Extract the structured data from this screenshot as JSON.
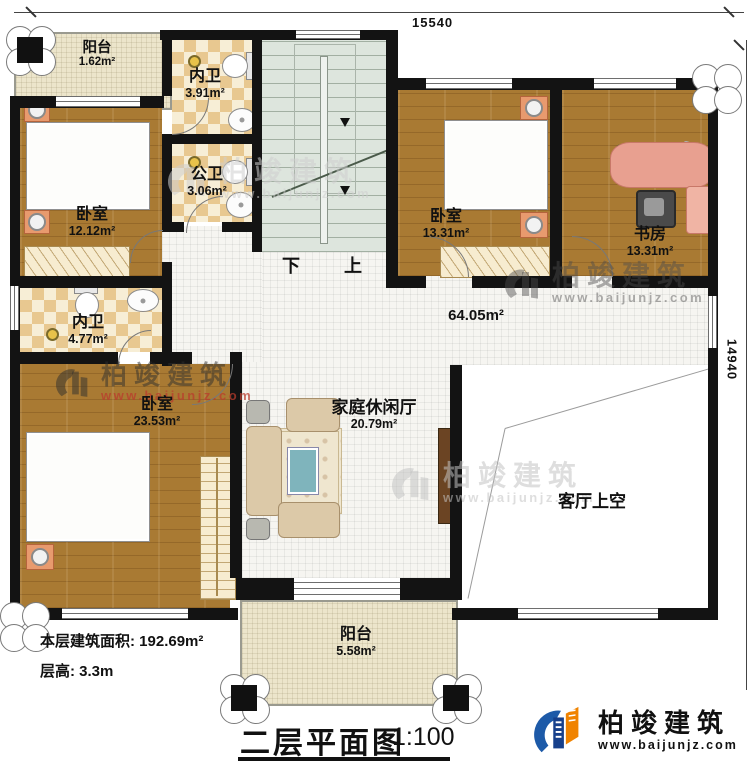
{
  "dimensions": {
    "top": "15540",
    "right": "14940"
  },
  "rooms": [
    {
      "id": "balcony-top",
      "name": "阳台",
      "area": "1.62m²"
    },
    {
      "id": "bath-top",
      "name": "内卫",
      "area": "3.91m²"
    },
    {
      "id": "bath-public",
      "name": "公卫",
      "area": "3.06m²"
    },
    {
      "id": "bedroom-1",
      "name": "卧室",
      "area": "12.12m²"
    },
    {
      "id": "bedroom-2",
      "name": "卧室",
      "area": "13.31m²"
    },
    {
      "id": "study",
      "name": "书房",
      "area": "13.31m²"
    },
    {
      "id": "hall",
      "name": "",
      "area": "64.05m²"
    },
    {
      "id": "bath-mid",
      "name": "内卫",
      "area": "4.77m²"
    },
    {
      "id": "bedroom-3",
      "name": "卧室",
      "area": "23.53m²"
    },
    {
      "id": "family-lounge",
      "name": "家庭休闲厅",
      "area": "20.79m²"
    },
    {
      "id": "living-void",
      "name": "客厅上空",
      "area": ""
    },
    {
      "id": "balcony-bottom",
      "name": "阳台",
      "area": "5.58m²"
    }
  ],
  "stairs": {
    "down": "下",
    "up": "上"
  },
  "info": {
    "area_line": "本层建筑面积: 192.69m²",
    "height_line": "层高: 3.3m"
  },
  "title": {
    "text": "二层平面图",
    "scale": "1:100"
  },
  "brand": {
    "name": "柏竣建筑",
    "url": "www.baijunjz.com"
  },
  "watermark": {
    "name": "柏竣建筑",
    "url": "www.baijunjz.com"
  },
  "colors": {
    "wall": "#131313",
    "wood": "#a97a33",
    "bath_tile": "#e8c890",
    "stair": "#dde5dd",
    "balcony": "#ece5cb",
    "brand_orange": "#f08300",
    "brand_blue": "#1d5aa8"
  }
}
